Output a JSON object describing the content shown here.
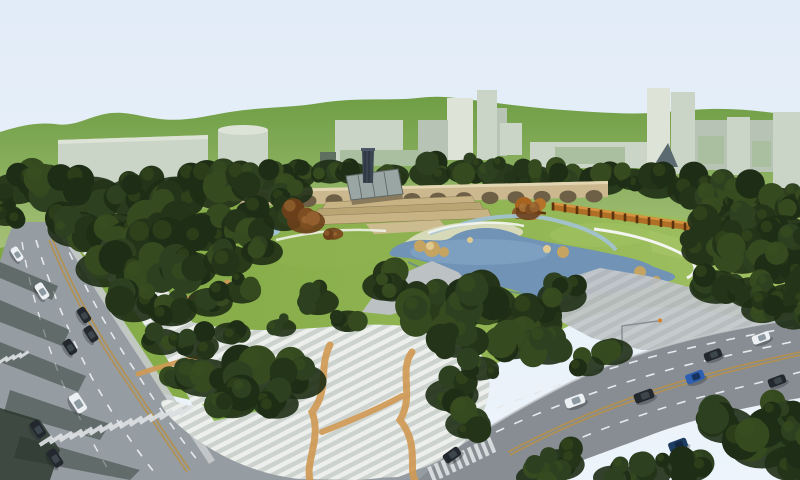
{
  "palette": {
    "sky_top": "#e2ecf8",
    "sky_low": "#edf4fb",
    "hill_top": "#6f9e45",
    "hill_base": "#a6c178",
    "building": "#cbd5c7",
    "building_shade": "#b7c3b4",
    "building_light": "#dde3d6",
    "glass_green": "#a9bf9f",
    "glass_dark": "#5f7060",
    "sail_dark": "#5b6a70",
    "tree_dark": "#243419",
    "tree_mid": "#2d4120",
    "tree_deep": "#1e2d15",
    "tree_olive": "#364a20",
    "tree_hi": "#3c531f",
    "lawn": "#7fa843",
    "lawn_mid": "#8fb351",
    "lawn_light": "#a2c263",
    "lawn_patch": "#8cb854",
    "pond": "#7093b6",
    "pond_sheen": "#8fb0cc",
    "pond_edge": "#587fa2",
    "stream": "#a3c2d6",
    "sand": "#d6dab9",
    "rock": "#c5a361",
    "rock_hi": "#dfc98e",
    "bridge": "#cbb88e",
    "bridge_hi": "#e2d6b2",
    "arch_shadow": "#6e6047",
    "terrace_a": "#c7b384",
    "terrace_b": "#b9a474",
    "stage_tan": "#cdbb90",
    "terrace_line": "#8d7a56",
    "glassroof": "#9aa6a4",
    "glassroof_frame": "#5d6765",
    "tower_dark": "#3b4552",
    "tower_stripe": "#242c36",
    "wall_orange": "#b06f26",
    "wall_orange_hi": "#d79440",
    "wall_post": "#59320e",
    "autumn_a": "#7c4e22",
    "autumn_b": "#935f2e",
    "autumn_c": "#6b3f1a",
    "autumn_d": "#a06c34",
    "autumn_hi": "#b07c3c",
    "road": "#969da2",
    "road_dark": "#878d92",
    "plaza_base": "#ccd2cd",
    "plaza_stripe": "#edefec",
    "plaza_gray": "#b5babd",
    "plaza_wedge": "#bcc1c3",
    "ribbon_orange": "#d09a55",
    "lane_dash": "#e6eaec",
    "lane_center": "#b3904e",
    "crosswalk": "#dde1e3",
    "shadow_green": "#2e3c34",
    "curb": "#c6cbcd",
    "path_white": "#f3f5f0",
    "terrace_wall": "#d8dcd4",
    "car_white": "#ecf0f2",
    "car_dark": "#23282e",
    "car_blue": "#2f5fb0",
    "car_navy": "#1e3d63",
    "lamp_gray": "#8a9094",
    "lamp_tip": "#d97f2a"
  },
  "bridge": {
    "arch_count": 14,
    "arch_start_x": 256,
    "arch_spacing": 26,
    "arch_rx": 8.5,
    "arch_ry": 6.2
  },
  "pergola_wall": {
    "x1": 553,
    "y1": 206.5,
    "x2": 697,
    "y2": 228.5,
    "post_count": 13,
    "post_w": 2.6,
    "post_h": 8
  },
  "crosswalks": [
    {
      "name": "left-road-crosswalk",
      "x": 46,
      "y": 441,
      "dx": 10,
      "dy": -2.2,
      "n": 15,
      "sw": 4,
      "sl": 15,
      "rot": 57
    },
    {
      "name": "left-median-crosswalk",
      "x": 3,
      "y": 360,
      "dx": 7,
      "dy": -1.8,
      "n": 4,
      "sw": 3,
      "sl": 11,
      "rot": 57
    },
    {
      "name": "right-road-crosswalk",
      "x": 432,
      "y": 474,
      "dx": 6.6,
      "dy": -3.2,
      "n": 10,
      "sw": 4,
      "sl": 16,
      "rot": -22
    }
  ],
  "cars": {
    "left_road": {
      "angle": 57,
      "list": [
        {
          "x": 17,
          "y": 254,
          "c": "white",
          "l": 15,
          "w": 8
        },
        {
          "x": 42,
          "y": 291,
          "c": "white",
          "l": 17,
          "w": 9
        },
        {
          "x": 84,
          "y": 315,
          "c": "dark",
          "l": 16,
          "w": 9
        },
        {
          "x": 91,
          "y": 334,
          "c": "dark",
          "l": 17,
          "w": 9
        },
        {
          "x": 70,
          "y": 347,
          "c": "dark",
          "l": 16,
          "w": 9
        },
        {
          "x": 78,
          "y": 403,
          "c": "white",
          "l": 20,
          "w": 11
        },
        {
          "x": 38,
          "y": 429,
          "c": "dark",
          "l": 18,
          "w": 10
        },
        {
          "x": 55,
          "y": 458,
          "c": "dark",
          "l": 19,
          "w": 10
        }
      ]
    },
    "right_road": {
      "angle": -20,
      "list": [
        {
          "x": 575,
          "y": 401,
          "c": "white",
          "l": 20,
          "w": 10
        },
        {
          "x": 644,
          "y": 396,
          "c": "dark",
          "l": 20,
          "w": 10
        },
        {
          "x": 695,
          "y": 377,
          "c": "blue",
          "l": 19,
          "w": 10
        },
        {
          "x": 713,
          "y": 355,
          "c": "dark",
          "l": 18,
          "w": 9
        },
        {
          "x": 761,
          "y": 338,
          "c": "white",
          "l": 18,
          "w": 9
        },
        {
          "x": 777,
          "y": 381,
          "c": "dark",
          "l": 18,
          "w": 9
        },
        {
          "x": 768,
          "y": 428,
          "c": "dark",
          "l": 18,
          "w": 10
        },
        {
          "x": 678,
          "y": 445,
          "c": "navy",
          "l": 19,
          "w": 10
        },
        {
          "x": 545,
          "y": 469,
          "c": "dark",
          "l": 20,
          "w": 11
        },
        {
          "x": 452,
          "y": 455,
          "c": "dark",
          "l": 18,
          "w": 10,
          "angle": -35
        }
      ]
    }
  },
  "tree_band": [
    [
      295,
      172,
      22
    ],
    [
      330,
      168,
      20
    ],
    [
      352,
      170,
      18
    ],
    [
      392,
      172,
      18
    ],
    [
      430,
      170,
      22
    ],
    [
      465,
      168,
      20
    ],
    [
      500,
      172,
      22
    ],
    [
      535,
      174,
      20
    ],
    [
      570,
      176,
      22
    ],
    [
      605,
      178,
      22
    ],
    [
      632,
      176,
      18
    ],
    [
      658,
      180,
      24
    ],
    [
      692,
      186,
      26
    ],
    [
      722,
      192,
      26
    ],
    [
      752,
      196,
      26
    ],
    [
      780,
      198,
      24
    ],
    [
      798,
      202,
      20
    ]
  ],
  "trees_main": [
    [
      6,
      212,
      18
    ],
    [
      0,
      196,
      14
    ],
    [
      16,
      184,
      26
    ],
    [
      52,
      186,
      30
    ],
    [
      92,
      190,
      32
    ],
    [
      134,
      192,
      32
    ],
    [
      176,
      190,
      32
    ],
    [
      218,
      186,
      30
    ],
    [
      258,
      182,
      28
    ],
    [
      292,
      188,
      22
    ],
    [
      76,
      224,
      30
    ],
    [
      118,
      228,
      34
    ],
    [
      162,
      230,
      34
    ],
    [
      206,
      226,
      32
    ],
    [
      248,
      220,
      28
    ],
    [
      284,
      214,
      22
    ],
    [
      104,
      264,
      30
    ],
    [
      146,
      268,
      32
    ],
    [
      188,
      264,
      30
    ],
    [
      228,
      256,
      26
    ],
    [
      262,
      248,
      22
    ],
    [
      134,
      302,
      26
    ],
    [
      172,
      306,
      26
    ],
    [
      210,
      298,
      24
    ],
    [
      242,
      288,
      20
    ],
    [
      162,
      338,
      22
    ],
    [
      198,
      342,
      22
    ],
    [
      230,
      330,
      18
    ],
    [
      182,
      374,
      20
    ],
    [
      318,
      298,
      22
    ],
    [
      348,
      318,
      18
    ],
    [
      282,
      325,
      15
    ],
    [
      385,
      282,
      24
    ],
    [
      205,
      372,
      32
    ],
    [
      252,
      378,
      34
    ],
    [
      298,
      376,
      30
    ],
    [
      232,
      398,
      26
    ],
    [
      276,
      400,
      24
    ],
    [
      392,
      286,
      20
    ],
    [
      436,
      306,
      36
    ],
    [
      484,
      298,
      34
    ],
    [
      530,
      318,
      34
    ],
    [
      562,
      292,
      26
    ],
    [
      512,
      336,
      30
    ],
    [
      458,
      336,
      28
    ],
    [
      548,
      346,
      24
    ],
    [
      452,
      390,
      28
    ],
    [
      468,
      420,
      24
    ],
    [
      480,
      365,
      20
    ],
    [
      612,
      348,
      22
    ],
    [
      588,
      363,
      17
    ],
    [
      726,
      420,
      30
    ],
    [
      762,
      442,
      34
    ],
    [
      793,
      458,
      30
    ],
    [
      688,
      462,
      26
    ],
    [
      648,
      470,
      24
    ],
    [
      612,
      474,
      20
    ],
    [
      782,
      410,
      24
    ],
    [
      800,
      432,
      22
    ],
    [
      560,
      460,
      26
    ],
    [
      535,
      474,
      20
    ],
    [
      712,
      216,
      26
    ],
    [
      748,
      222,
      28
    ],
    [
      782,
      226,
      26
    ],
    [
      800,
      238,
      22
    ],
    [
      706,
      246,
      26
    ],
    [
      742,
      252,
      28
    ],
    [
      778,
      258,
      26
    ],
    [
      800,
      268,
      20
    ],
    [
      716,
      282,
      28
    ],
    [
      752,
      288,
      26
    ],
    [
      788,
      294,
      24
    ],
    [
      762,
      306,
      22
    ],
    [
      793,
      314,
      20
    ]
  ],
  "trees_autumn": [
    [
      306,
      218,
      20
    ],
    [
      333,
      232,
      10
    ],
    [
      528,
      210,
      13
    ]
  ]
}
